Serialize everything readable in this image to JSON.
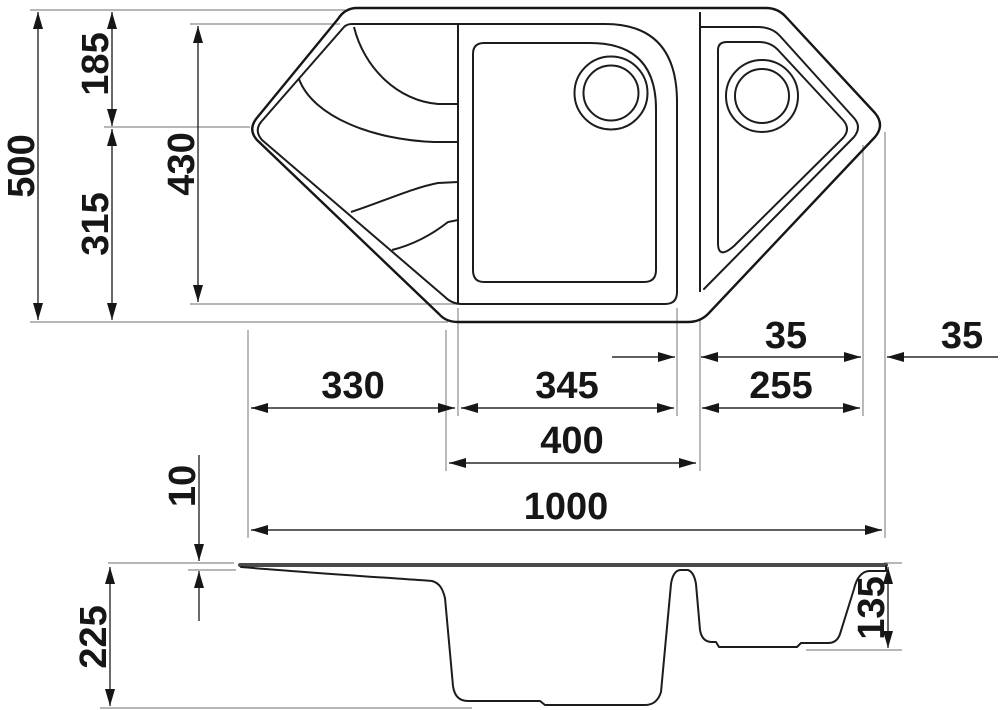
{
  "diagram": {
    "subject": "corner-kitchen-sink-technical-drawing",
    "units": "mm",
    "colors": {
      "line": "#161616",
      "extension": "#8c8c8c",
      "background": "#ffffff"
    },
    "dims": {
      "overall_width": "1000",
      "overall_depth": "500",
      "vertex_offset_top": "185",
      "vertex_offset_bottom": "315",
      "inner_depth": "430",
      "drainboard_width": "330",
      "main_bowl_width": "345",
      "bowl_outer_width": "400",
      "corner_bowl_width": "255",
      "divider_rim_width": "35",
      "edge_rim_width": "35",
      "rim_height": "10",
      "overall_height": "225",
      "corner_bowl_depth": "135"
    }
  }
}
